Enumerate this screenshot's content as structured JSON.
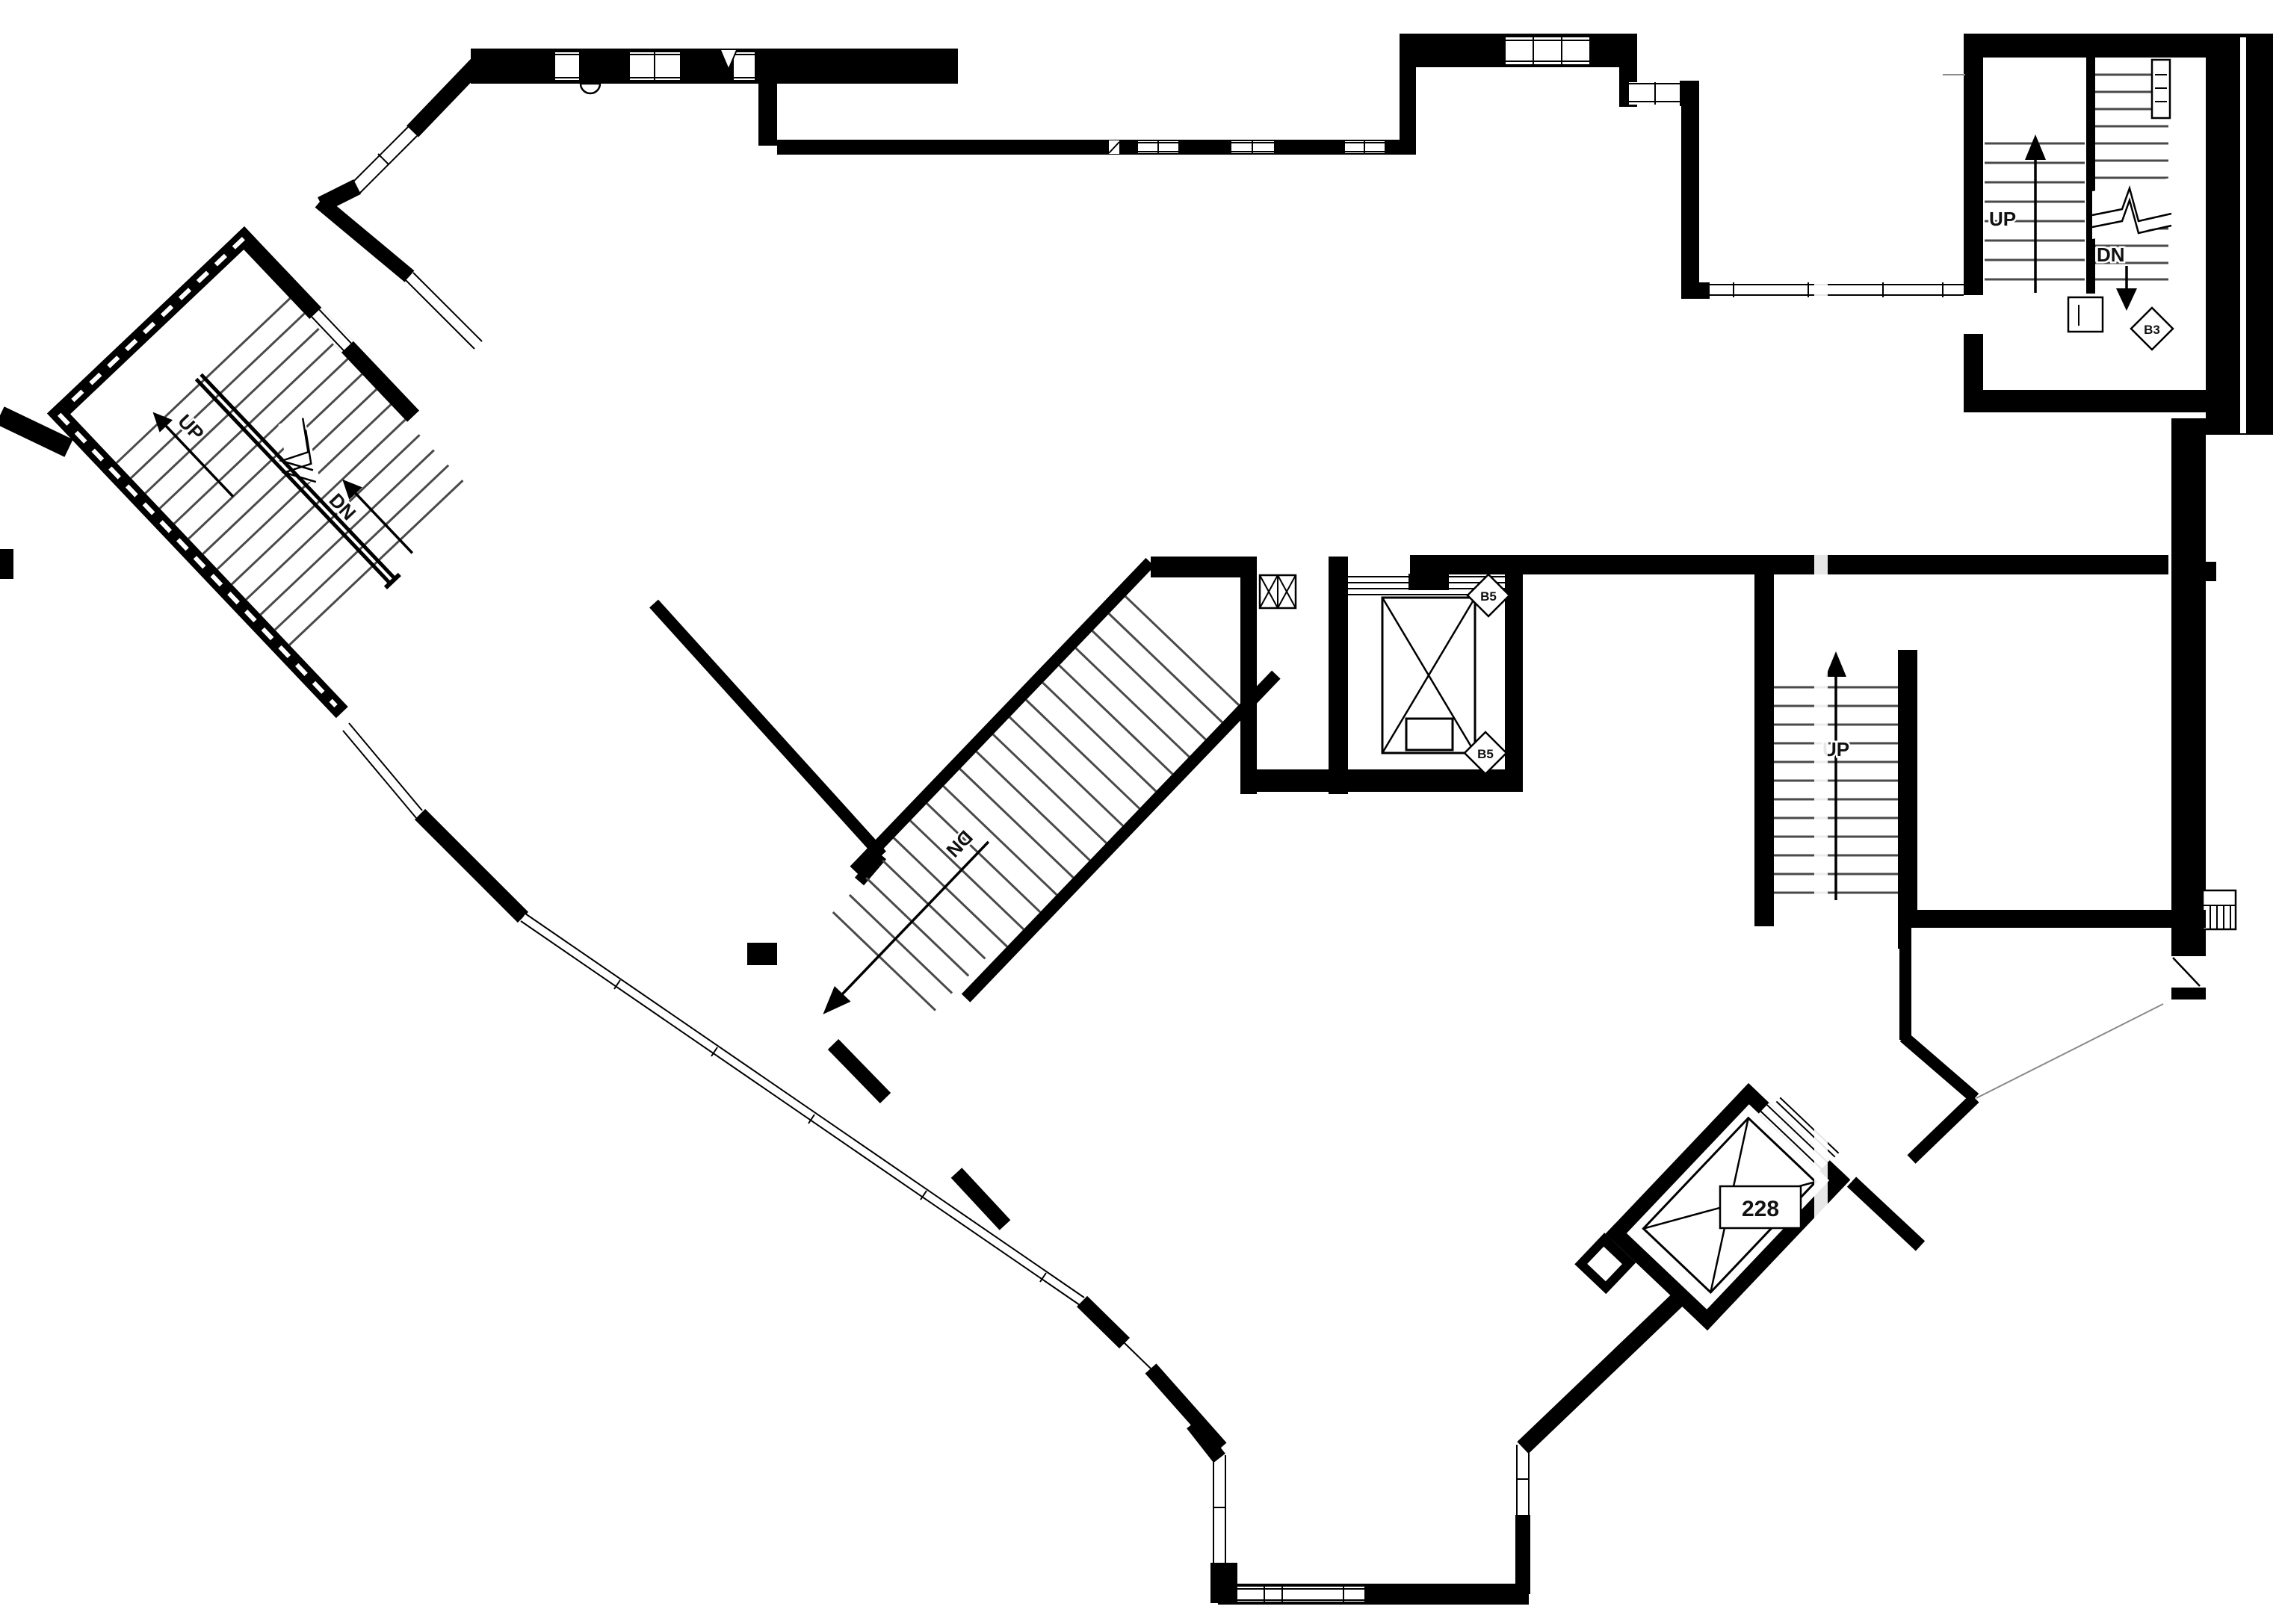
{
  "drawing": {
    "type": "architectural-floor-plan",
    "colors": {
      "wall": "#000000",
      "background": "#ffffff",
      "tread": "#4a4a4a",
      "faint": "#8a8a8a"
    },
    "stairs": {
      "left": {
        "up_label": "UP",
        "down_label": "DN"
      },
      "top_right": {
        "up_label": "UP",
        "down_label": "DN",
        "tag": "B3"
      },
      "center": {
        "down_label": "DN"
      },
      "right": {
        "up_label": "UP"
      }
    },
    "elevators": {
      "passenger": {
        "tag_upper": "B5",
        "tag_lower": "B5"
      },
      "freight": {
        "room_number": "228"
      }
    }
  }
}
